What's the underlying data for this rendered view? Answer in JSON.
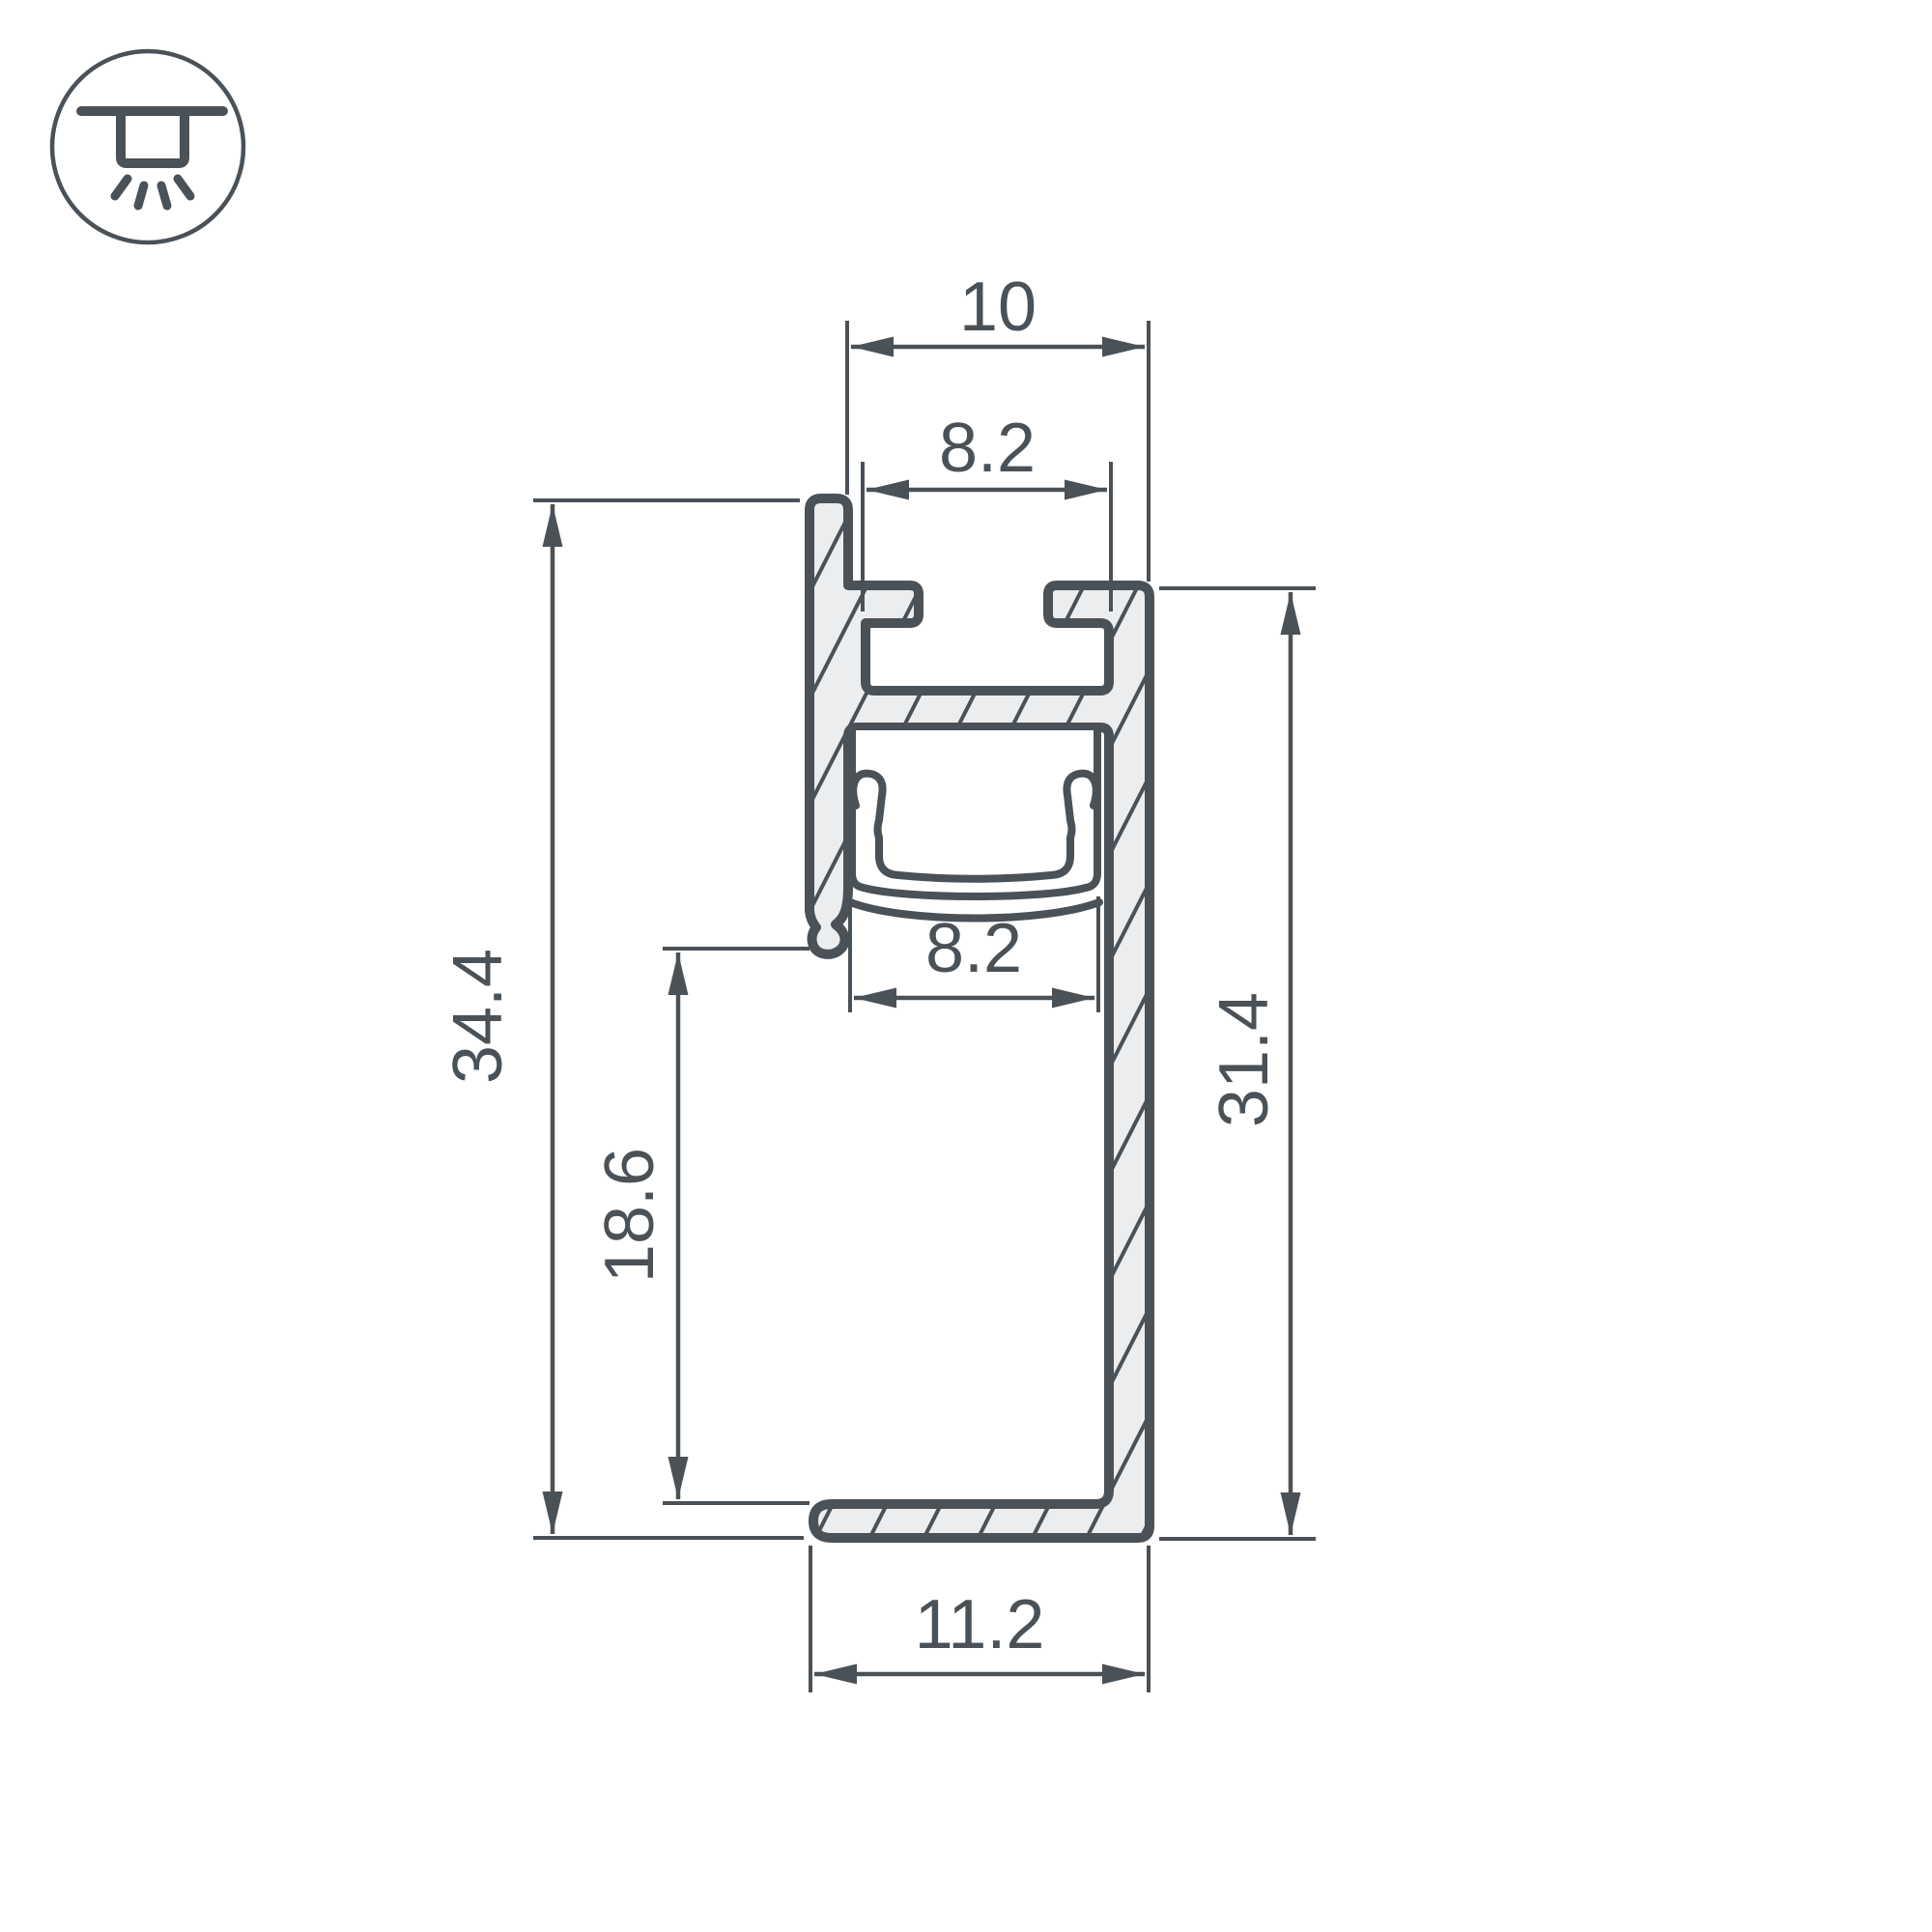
{
  "colors": {
    "line": "#4a5157",
    "fill": "#ecedee",
    "background": "#ffffff"
  },
  "icon": {
    "name": "recessed-ceiling-light",
    "description": "ceiling-mounted downlight symbol in circle"
  },
  "drawing": {
    "type": "profile-cross-section",
    "dims": {
      "top_width": "10",
      "top_slot_width": "8.2",
      "led_slot_width": "8.2",
      "base_width": "11.2",
      "height_overall": "34.4",
      "height_inner": "18.6",
      "height_right": "31.4"
    }
  }
}
